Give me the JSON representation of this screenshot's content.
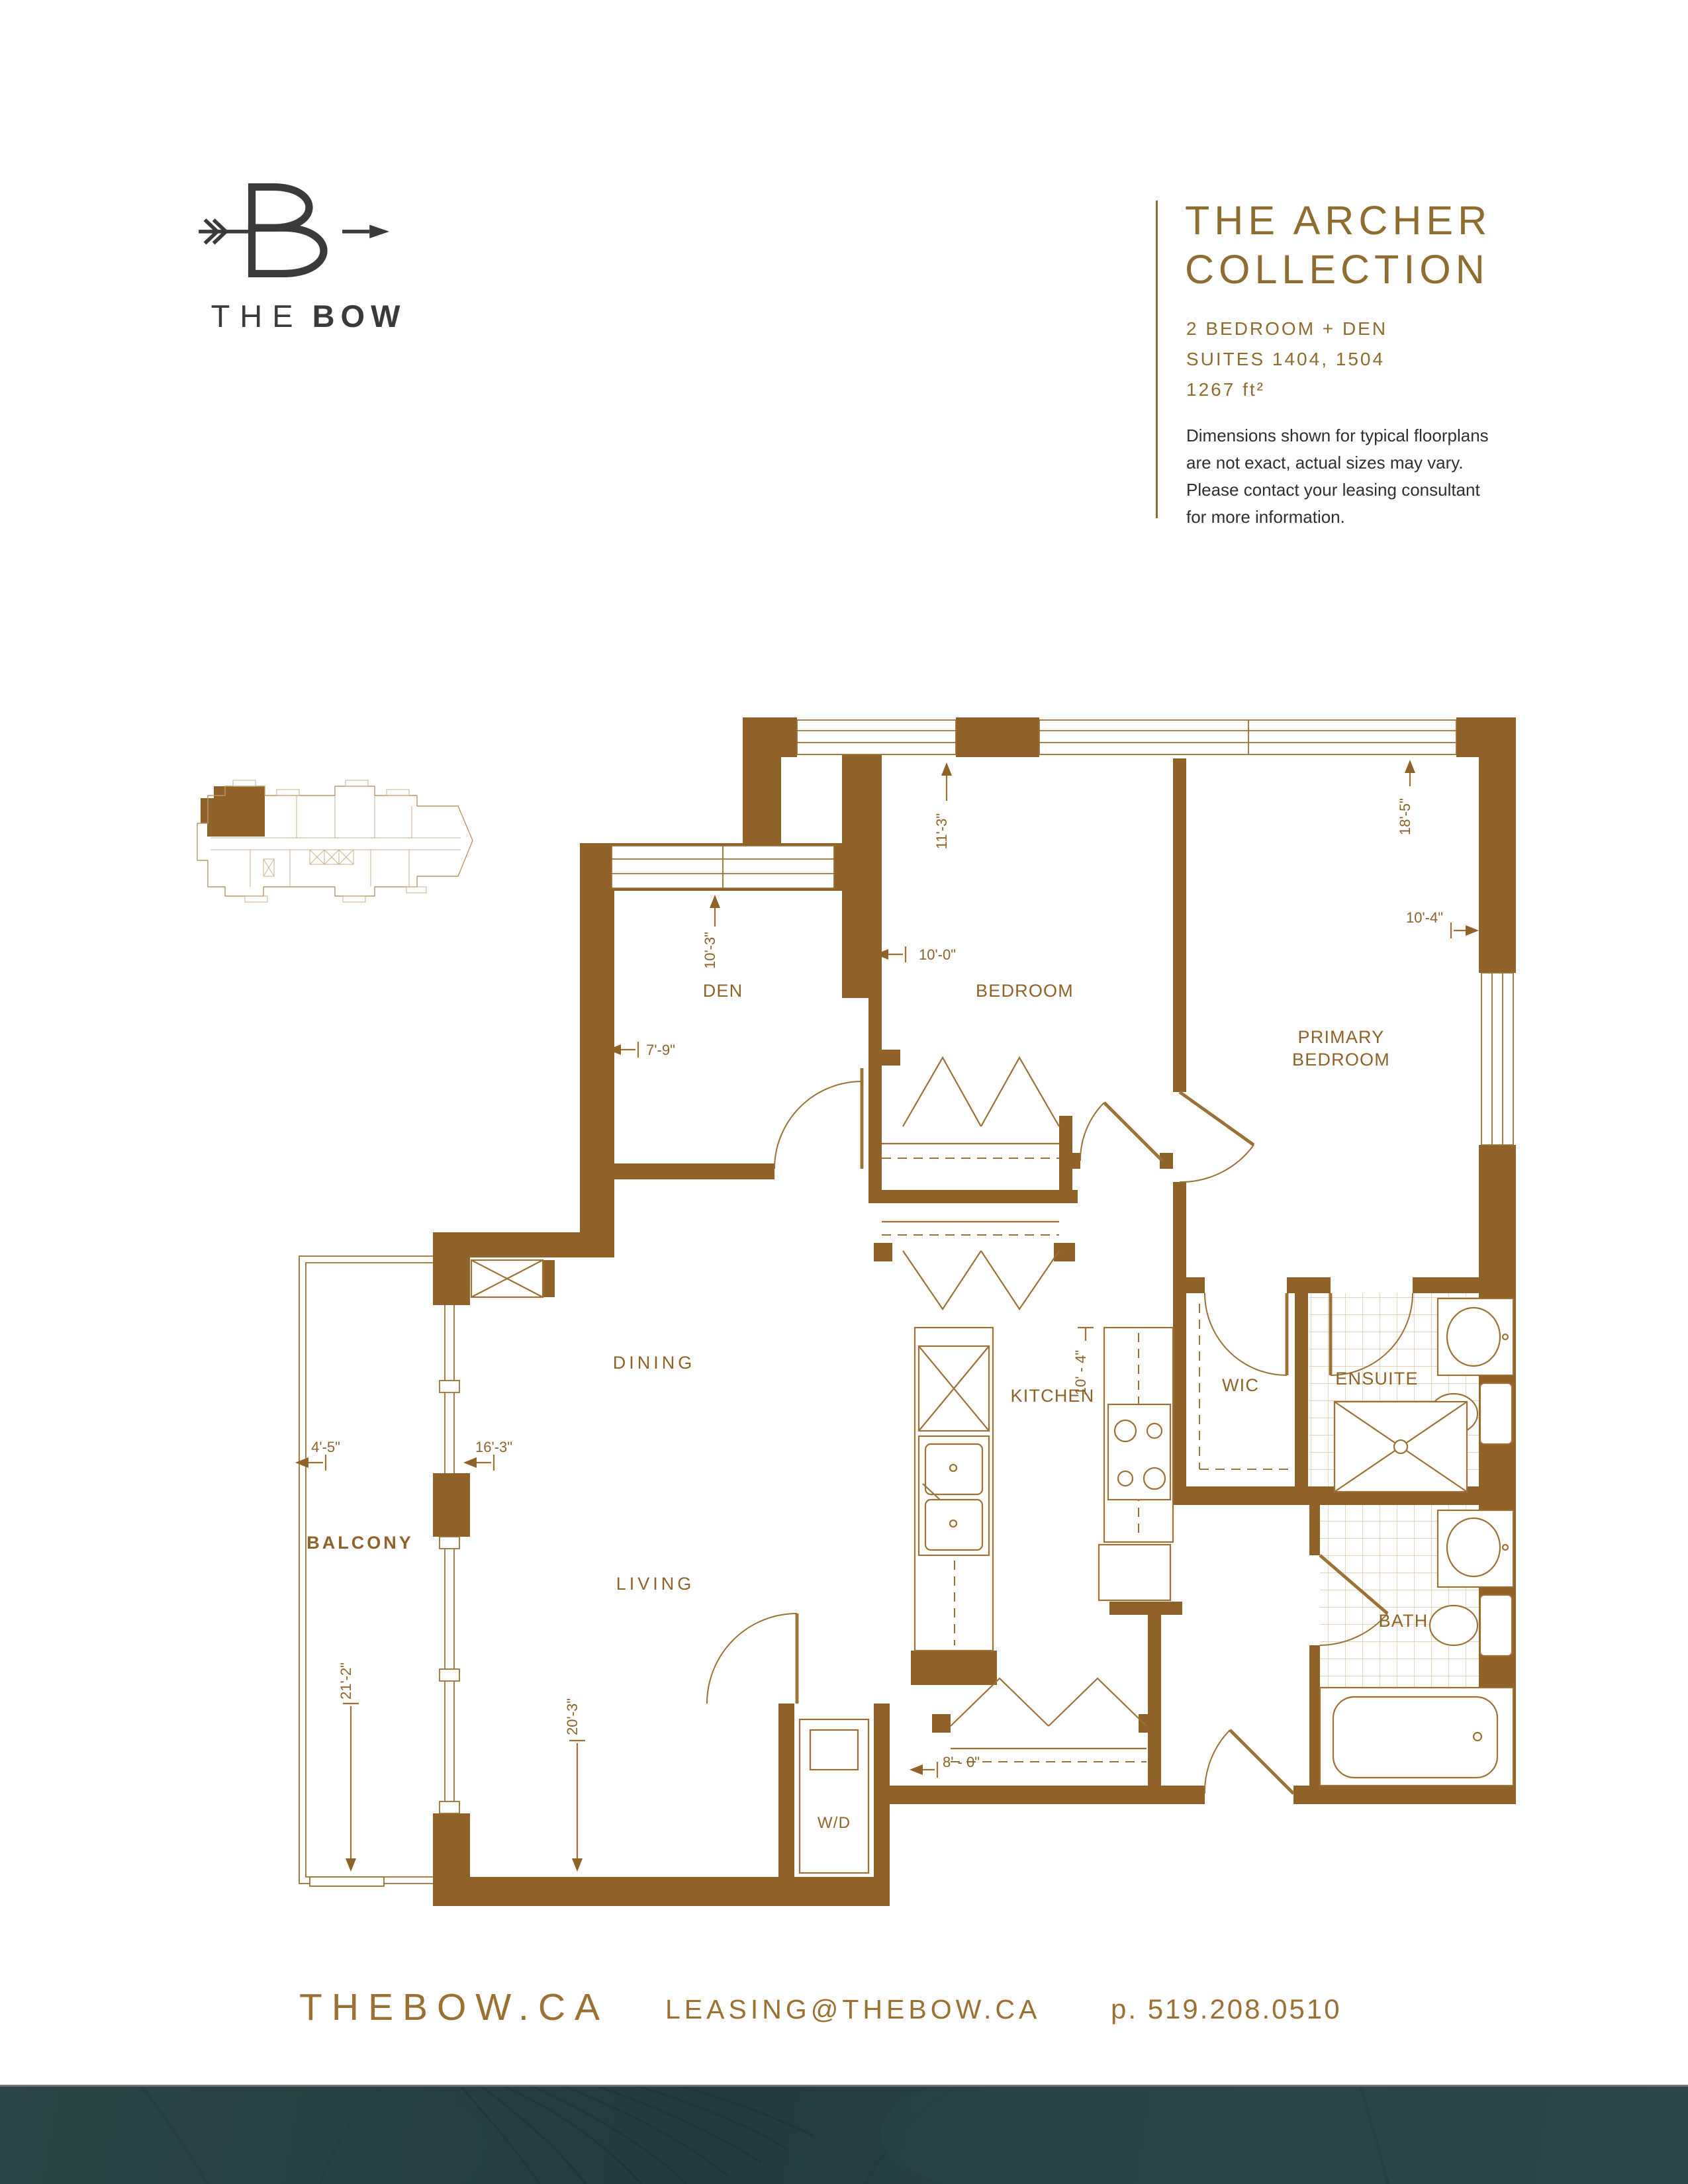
{
  "logo": {
    "the": "THE",
    "bow": "BOW"
  },
  "header": {
    "title_line1": "THE ARCHER",
    "title_line2": "COLLECTION",
    "unit_type": "2 BEDROOM + DEN",
    "suites": "SUITES 1404, 1504",
    "area": "1267 ft²",
    "disclaimer_line1": "Dimensions shown for typical floorplans",
    "disclaimer_line2": "are not exact, actual sizes may vary.",
    "disclaimer_line3": "Please contact your leasing consultant",
    "disclaimer_line4": "for more information."
  },
  "plan": {
    "rooms": {
      "den": "DEN",
      "bedroom": "BEDROOM",
      "primary_line1": "PRIMARY",
      "primary_line2": "BEDROOM",
      "dining": "DINING",
      "kitchen": "KITCHEN",
      "wic": "WIC",
      "ensuite": "ENSUITE",
      "bath": "BATH",
      "living": "LIVING",
      "balcony": "BALCONY",
      "wd": "W/D"
    },
    "dims": {
      "den_v": "10'-3\"",
      "den_h": "7'-9\"",
      "bedroom_v": "11'-3\"",
      "bedroom_h": "10'-0\"",
      "primary_v": "18'-5\"",
      "primary_h": "10'-4\"",
      "kitchen_v": "10' - 4\"",
      "kitchen_h": "8' - 0\"",
      "balcony_h": "4'-5\"",
      "dining_h": "16'-3\"",
      "balcony_v": "21'-2\"",
      "living_v": "20'-3\""
    }
  },
  "footer": {
    "website": "THEBOW.CA",
    "email": "LEASING@THEBOW.CA",
    "phone": "p. 519.208.0510"
  },
  "colors": {
    "wall": "#8F6229",
    "accent": "#8F6C2F",
    "logo": "#3A3A3C",
    "strip": "#2B4044"
  }
}
